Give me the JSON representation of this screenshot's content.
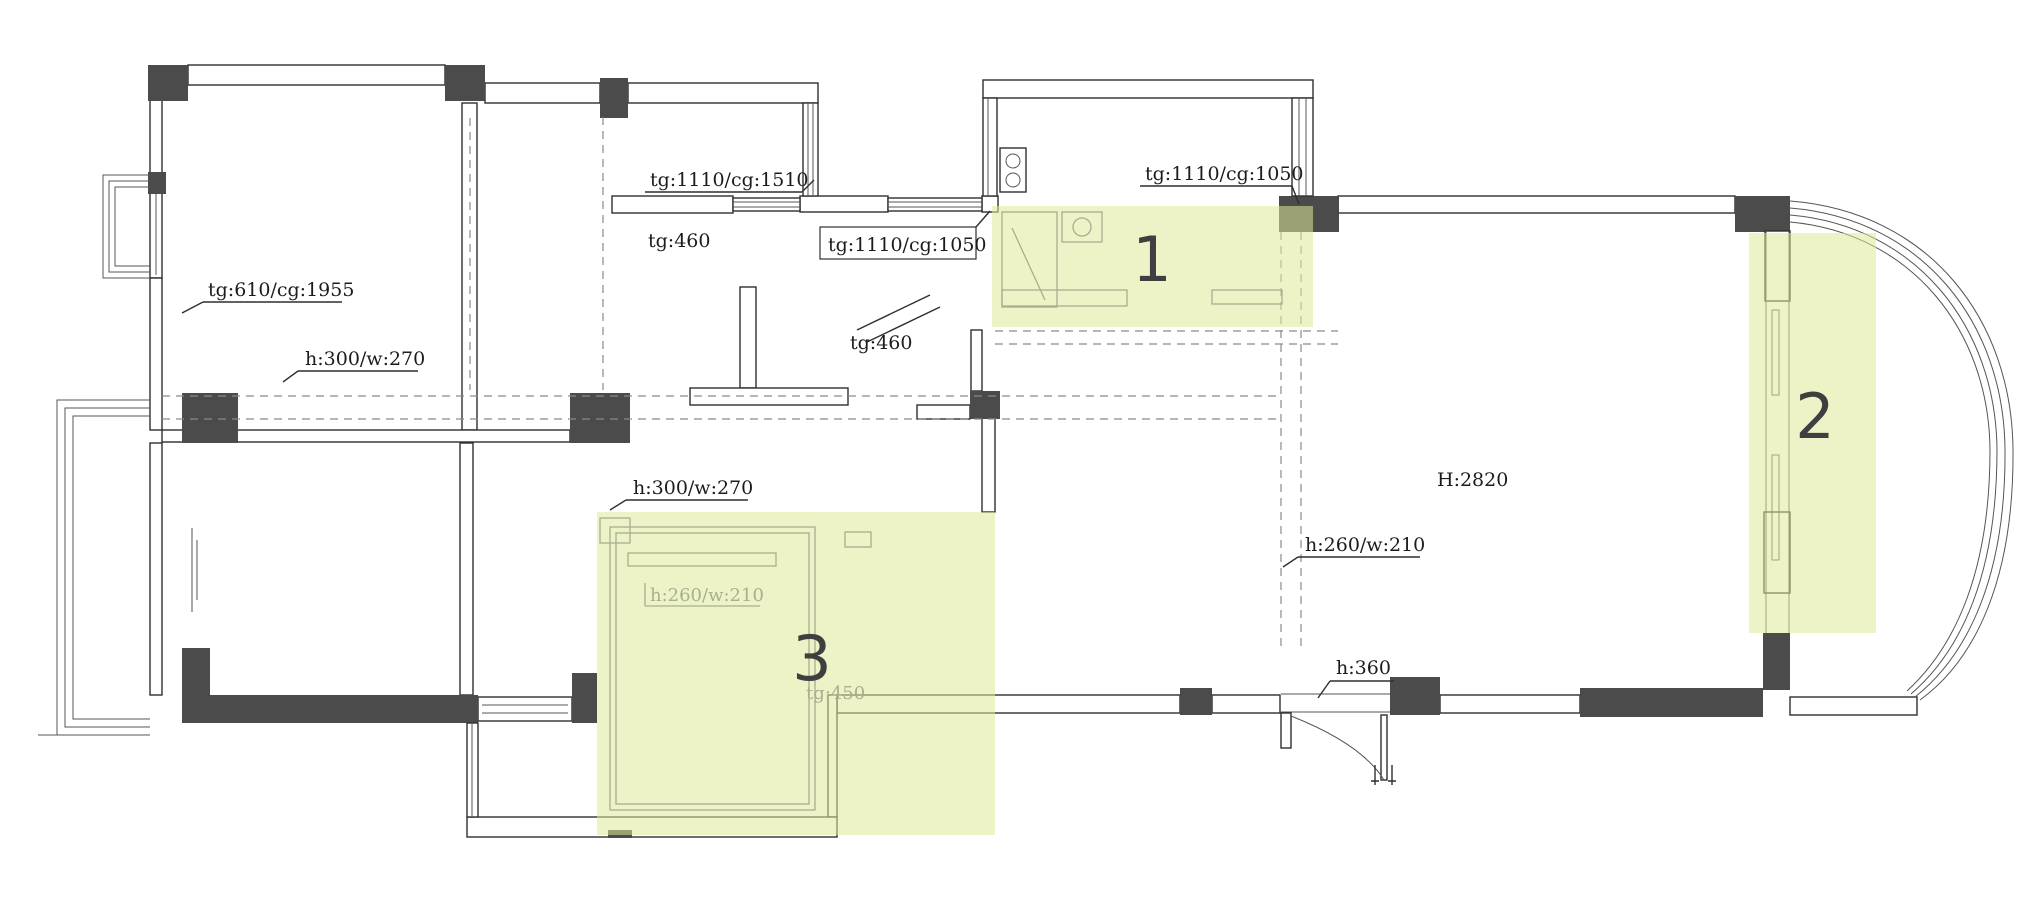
{
  "drawing": {
    "title": "apartment-floor-plan",
    "canvas": {
      "width": 2022,
      "height": 905,
      "background": "#ffffff"
    },
    "colors": {
      "highlight_fill": "rgba(223,232,153,0.55)",
      "wall_dark": "#4b4b4b",
      "line": "#2f2f2f",
      "faint_annotation": "#a9ae90",
      "dashed_beam": "#8a8a8a",
      "text": "#1c1c1c",
      "region_marker": "#3f3f3f"
    },
    "regions": {
      "r1": {
        "label": "1"
      },
      "r2": {
        "label": "2"
      },
      "r3": {
        "label": "3"
      }
    },
    "annotations": {
      "balcony_door": "tg:610/cg:1955",
      "beam_left": "h:300/w:270",
      "beam_left2": "h:300/w:270",
      "bath_window": "tg:1110/cg:1510",
      "bath_sill": "tg:460",
      "hall_window": "tg:1110/cg:1050",
      "hall_sill": "tg:460",
      "kitchen_window": "tg:1110/cg:1050",
      "beam_faint": "h:260/w:210",
      "beam_right": "h:260/w:210",
      "ceiling_height": "H:2820",
      "entry_beam": "h:360",
      "region3_sill": "tg:450"
    }
  }
}
